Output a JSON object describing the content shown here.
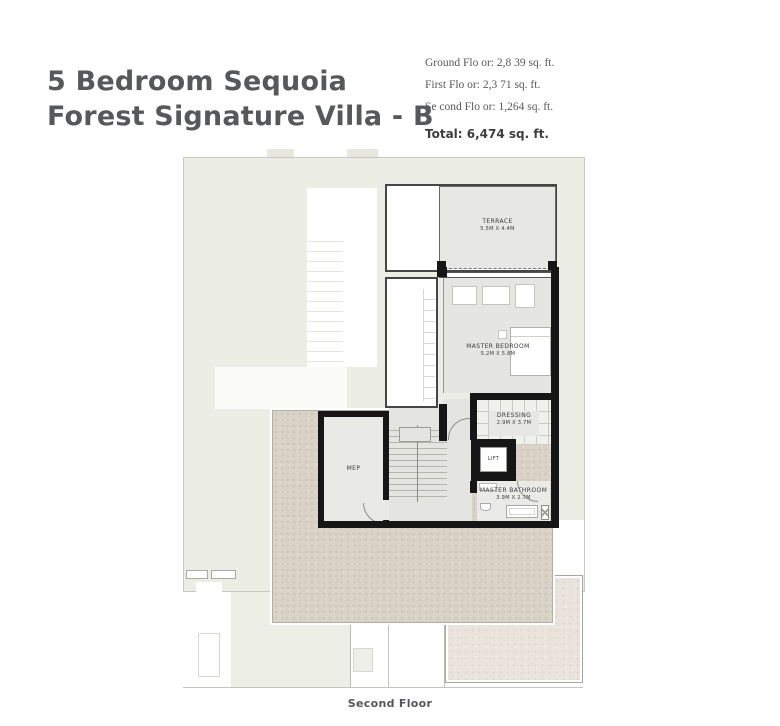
{
  "header": {
    "title_line1": "5 Bedroom Sequoia",
    "title_line2": "Forest Signature Villa - B",
    "stats": [
      "Ground Flo or: 2,8 39 sq. ft.",
      "First Flo or: 2,3 71 sq. ft.",
      "Se cond Flo or: 1,264 sq. ft."
    ],
    "total": "Total: 6,474 sq. ft."
  },
  "plan": {
    "caption": "Second Floor",
    "rooms": {
      "terrace": {
        "name": "TERRACE",
        "dims": "5.5M X 4.4M"
      },
      "master_bedroom": {
        "name": "MASTER BEDROOM",
        "dims": "5.2M X 5.8M"
      },
      "dressing": {
        "name": "DRESSING",
        "dims": "2.9M X 3.7M"
      },
      "lift": {
        "name": "LIFT"
      },
      "master_bathroom": {
        "name": "MASTER BATHROOM",
        "dims": "3.9M X 2.7M"
      },
      "mep": {
        "name": "MEP"
      }
    }
  },
  "colors": {
    "title_text": "#57585a",
    "stats_text": "#585858",
    "wall_black": "#161616",
    "footprint_light": "#ecede5",
    "room_gray": "#e5e6e1",
    "roof_terrace_beige": "#d9d2c6",
    "bottom_room_pink": "#e9e3dc"
  }
}
